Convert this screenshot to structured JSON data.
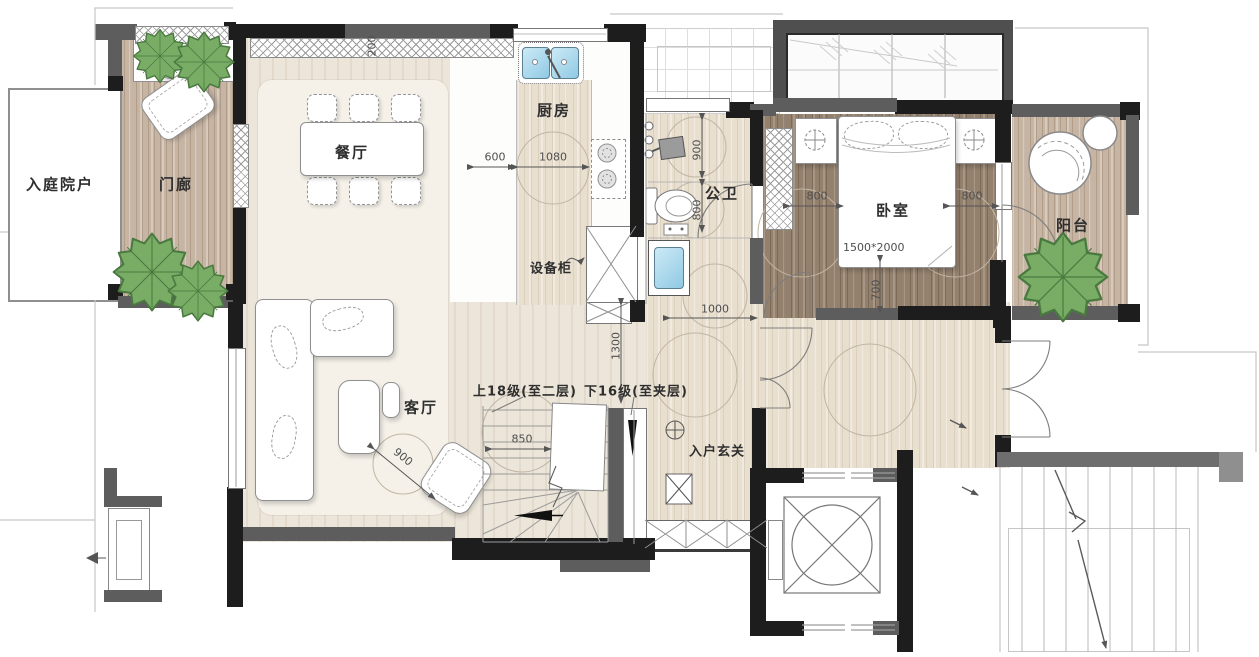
{
  "plan": {
    "rooms": {
      "courtyard": "入庭院户",
      "porch": "门廊",
      "dining": "餐厅",
      "kitchen": "厨房",
      "equipment_cabinet": "设备柜",
      "bathroom": "公卫",
      "bedroom": "卧室",
      "balcony": "阳台",
      "living": "客厅",
      "foyer": "入户玄关"
    },
    "stairs": {
      "up": "上18级(至二层)",
      "down": "下16级(至夹层)"
    },
    "bed_size": "1500*2000",
    "dimensions": {
      "cabinet_depth": "200",
      "kitchen_left": "600",
      "kitchen_span": "1080",
      "bath_shower": "900",
      "bath_wc": "800",
      "hall_width": "1000",
      "bed_left": "800",
      "bed_right": "800",
      "bed_foot": "700",
      "stair_width": "850",
      "stair_well": "1300",
      "armchair": "900"
    },
    "colors": {
      "wall_dark": "#1d1d1d",
      "wall_gray": "#5d5d5d",
      "floor_cream": "#ece5d9",
      "rug": "#f5f1e9",
      "wood_porch": "#c7b5a4",
      "wood_bedroom": "#93806d",
      "wood_hall": "#e9dfcf",
      "plant_green": "#79ad66",
      "water_blue": "#aee0f2"
    },
    "icons": [
      "tree-icon",
      "dining-table-icon",
      "chair-icon",
      "sofa-icon",
      "coffee-table-icon",
      "armchair-icon",
      "bed-icon",
      "pillow-icon",
      "nightstand-icon",
      "wardrobe-icon",
      "sink-icon",
      "stove-icon",
      "shower-icon",
      "toilet-icon",
      "washing-machine-icon",
      "elevator-icon",
      "stair-arrow-icon",
      "lounge-chair-icon",
      "bay-window-icon",
      "door-arc-icon",
      "downlight-icon",
      "shoe-cabinet-icon",
      "ac-unit-icon"
    ]
  }
}
